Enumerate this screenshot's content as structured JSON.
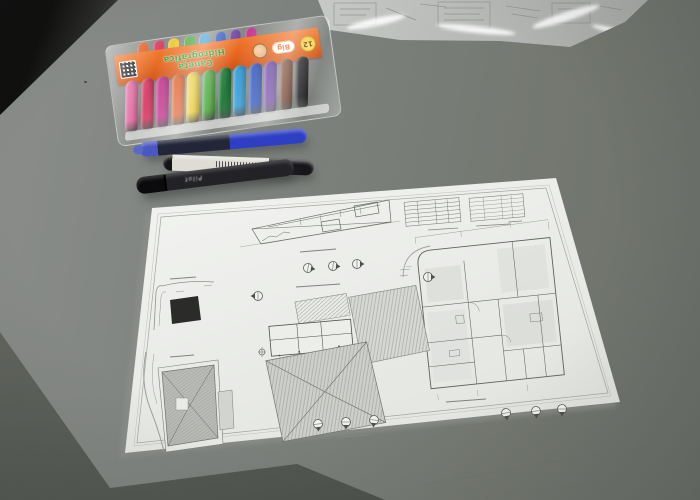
{
  "pack": {
    "brand_line1": "Caneta",
    "brand_line2": "Hidrográfica",
    "big_label": "Big",
    "badge": "12",
    "pen_colors": [
      "#e2679e",
      "#d93a63",
      "#c42f8b",
      "#e0571f",
      "#e8c825",
      "#46a637",
      "#1f7a38",
      "#2f9bd8",
      "#2b52c0",
      "#6a3fa2",
      "#703a28",
      "#1d1d20"
    ],
    "cap_colors": [
      "#e0571f",
      "#d93a63",
      "#e8c825",
      "#46a637",
      "#2f9bd8",
      "#2b52c0",
      "#6a3fa2",
      "#c42f8b"
    ]
  },
  "markers": {
    "black_imprint": "Pilot"
  },
  "palette": {
    "table": "#7e827e",
    "table_dark": "#5a5e58",
    "paper": "#e9ebe8",
    "sheet": "#f2f3f0",
    "header_orange": "#e8641c",
    "brand_green": "#2a9a1e",
    "blueprint_line": "#6e716c"
  }
}
